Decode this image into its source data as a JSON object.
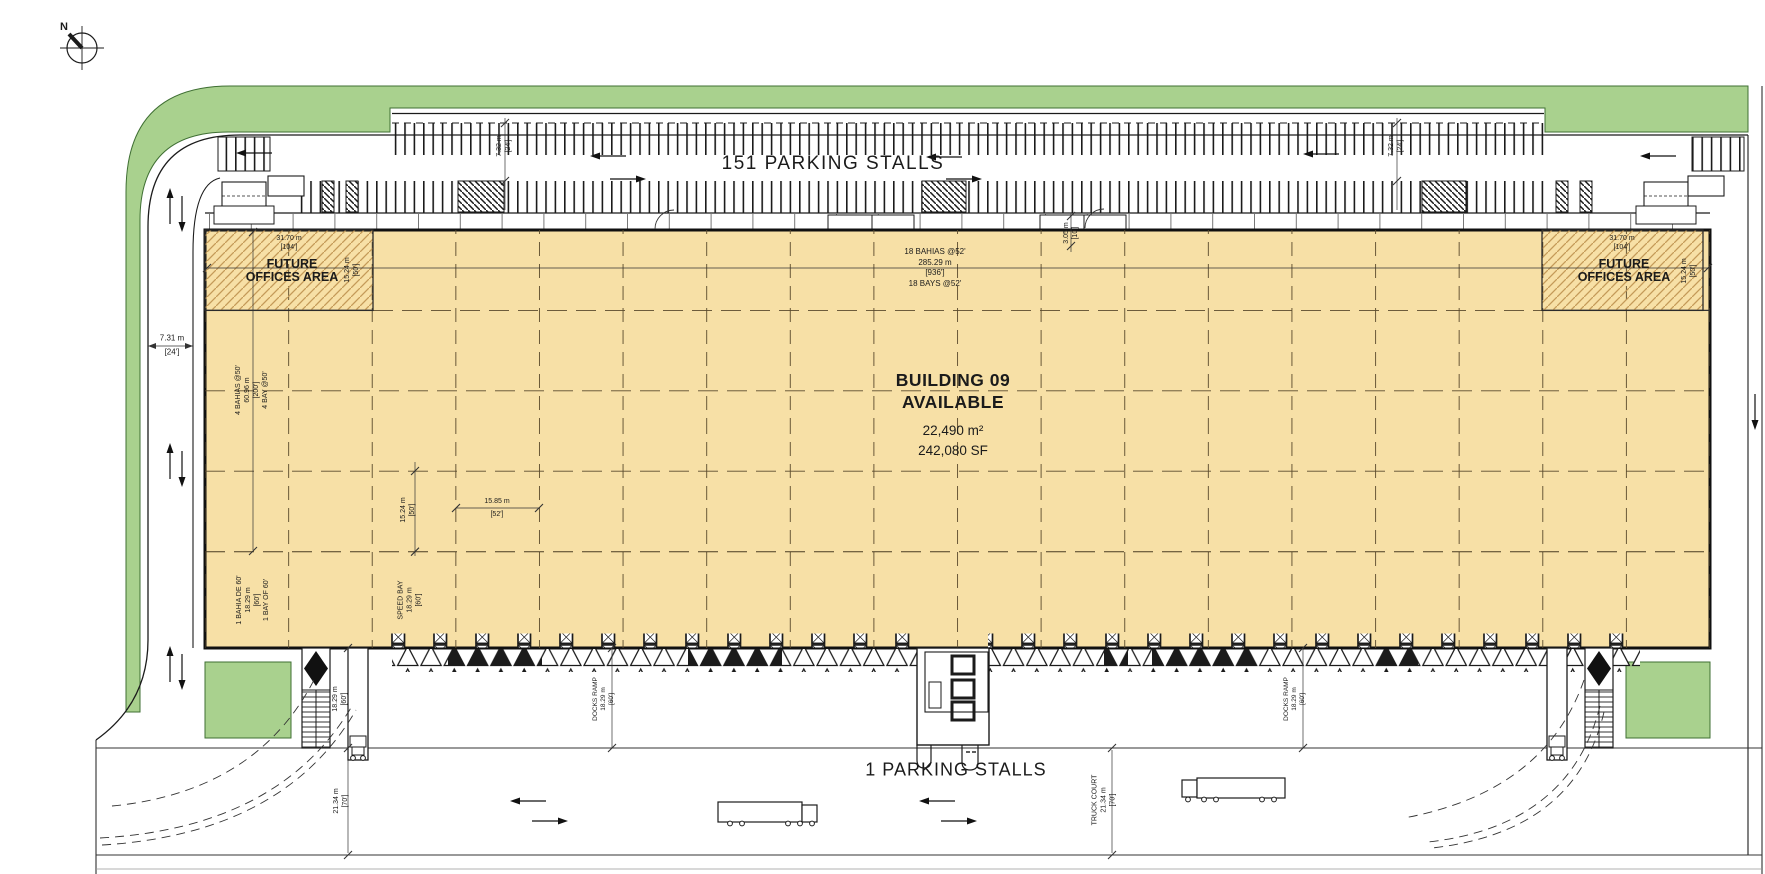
{
  "title": "Building 09 site plan",
  "compass": {
    "north_label": "N"
  },
  "parking": {
    "north_row_label": "151 PARKING STALLS",
    "south_row_label": "1 PARKING STALLS"
  },
  "building": {
    "name": "BUILDING 09",
    "status": "AVAILABLE",
    "area_metric": "22,490 m²",
    "area_imperial": "242,080 SF"
  },
  "offices": {
    "label_line1": "FUTURE",
    "label_line2": "OFFICES AREA",
    "width_m": "31.70 m",
    "width_ft": "[104']",
    "depth_m": "15.24 m",
    "depth_ft": "[50']"
  },
  "dimensions": {
    "west_drive": {
      "m": "7.31 m",
      "ft": "[24']"
    },
    "north_drive": {
      "m": "7.32 m",
      "ft": "[24']"
    },
    "bays_horizontal": {
      "line1": "18 BAHIAS @52'",
      "line2": "285.29 m",
      "line3": "[936']",
      "line4": "18 BAYS @52'"
    },
    "bays_vertical": {
      "line1": "4 BAHIAS @50'",
      "line2": "60.96 m",
      "line3": "[200']",
      "line4": "4 BAY @50'"
    },
    "column_offset": {
      "m": "3.05 m",
      "ft": "[10']"
    },
    "bay_depth": {
      "m": "15.24 m",
      "ft": "[50']"
    },
    "bay_width": {
      "m": "15.85 m",
      "ft": "[52']"
    },
    "speed_bay_es": {
      "line1": "1 BAHIA DE 60'",
      "line2": "18.29 m",
      "line3": "[60']",
      "line4": "1 BAY OF 60'"
    },
    "speed_bay": {
      "line1": "SPEED BAY",
      "line2": "18.29 m",
      "line3": "[60']"
    },
    "docks_ramp": {
      "line1": "DOCKS RAMP",
      "line2": "18.29 m",
      "line3": "[60']"
    },
    "ramp_depth": {
      "m": "18.29 m",
      "ft": "[60']"
    },
    "truck_court_west": {
      "m": "21.34 m",
      "ft": "[70']"
    },
    "truck_court": {
      "line1": "TRUCK COURT",
      "line2": "21.34 m",
      "line3": "[70']"
    }
  },
  "colors": {
    "building_fill": "#F7E0A6",
    "landscape": "#A9D18E",
    "office_hatch": "#C49A58",
    "linework": "#1B1B1B"
  }
}
